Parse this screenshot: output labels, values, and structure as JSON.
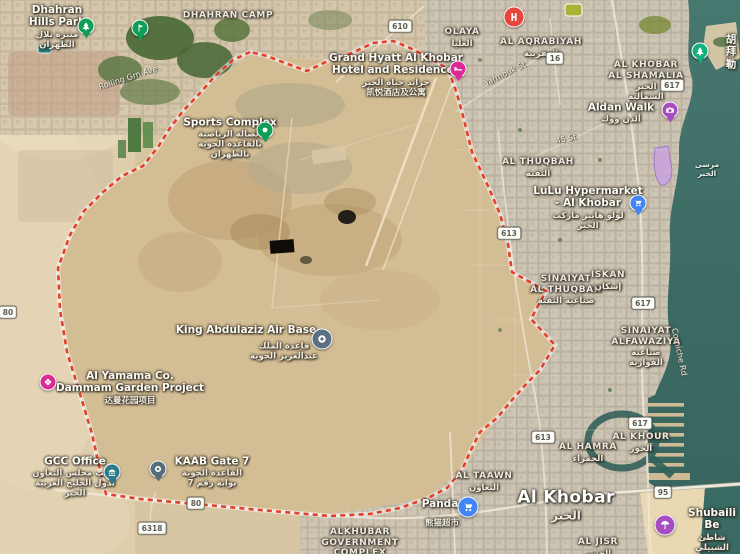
{
  "map": {
    "description": "Satellite map of King Abdulaziz Air Base and Al Khobar, Saudi Arabia",
    "boundary_color": "#e2402c",
    "labels": [
      {
        "id": "dhahran-hills-park",
        "type": "poi",
        "x": 57,
        "y": 27,
        "text": "Dhahran\nHills Park",
        "sub": "منتزه تلال\nالظهران"
      },
      {
        "id": "dhahran-camp",
        "type": "district",
        "x": 228,
        "y": 16,
        "text": "DHAHRAN CAMP",
        "sub": ""
      },
      {
        "id": "olaya",
        "type": "district",
        "x": 462,
        "y": 38,
        "text": "OLAYA",
        "sub": "العليا"
      },
      {
        "id": "al-aqrabiyah",
        "type": "district",
        "x": 541,
        "y": 48,
        "text": "AL AQRABIYAH",
        "sub": "العقربية"
      },
      {
        "id": "al-khobar-al-shamalia",
        "type": "district",
        "x": 646,
        "y": 81,
        "text": "AL KHOBAR\nAL SHAMALIA",
        "sub": "الخبر\nالشمالية"
      },
      {
        "id": "hubail-cn",
        "type": "poi",
        "x": 731,
        "y": 52,
        "text": "胡拜勒",
        "sub": ""
      },
      {
        "id": "grand-hyatt",
        "type": "poi",
        "x": 396,
        "y": 75,
        "text": "Grand Hyatt Al Khobar\nHotel and Residences",
        "sub": "جراند حياة الخبر\n凯悦酒店及公寓"
      },
      {
        "id": "aldan-walk",
        "type": "poi",
        "x": 621,
        "y": 113,
        "text": "Aldan Walk",
        "sub": "ألدن ووك"
      },
      {
        "id": "sports-complex",
        "type": "poi",
        "x": 230,
        "y": 138,
        "text": "Sports Complex",
        "sub": "الصالة الرياضية\nبالقاعدة الجوية\nبالظهران"
      },
      {
        "id": "al-thuqbah",
        "type": "district",
        "x": 538,
        "y": 168,
        "text": "AL THUQBAH",
        "sub": "الثقبة"
      },
      {
        "id": "lulu-hypermarket",
        "type": "poi",
        "x": 588,
        "y": 208,
        "text": "LuLu Hypermarket\n- Al Khobar",
        "sub": "لولو هايبر ماركت\nالخبر"
      },
      {
        "id": "khobar-marina-ar",
        "type": "water",
        "x": 707,
        "y": 170,
        "text": "مرسى الخبر",
        "sub": ""
      },
      {
        "id": "sinaiyat-al-thuqbah",
        "type": "district",
        "x": 566,
        "y": 290,
        "text": "SINAIYAT\nAL THUQBAH",
        "sub": "صناعية الثقبة"
      },
      {
        "id": "iskan",
        "type": "district",
        "x": 608,
        "y": 281,
        "text": "ISKAN",
        "sub": "إسكان"
      },
      {
        "id": "sinaiyat-alfawaziya",
        "type": "district",
        "x": 646,
        "y": 347,
        "text": "SINAIYAT\nALFAWAZIYA",
        "sub": "صناعية\nالفوازية"
      },
      {
        "id": "corniche-rd",
        "type": "street",
        "x": 679,
        "y": 352,
        "rot": 78,
        "text": "Corniche Rd",
        "sub": ""
      },
      {
        "id": "king-abdulaziz-air-base",
        "type": "poi",
        "x": 246,
        "y": 330,
        "text": "King Abdulaziz Air Base",
        "sub": ""
      },
      {
        "id": "king-abdulaziz-air-base-ar",
        "type": "subonly",
        "x": 284,
        "y": 351,
        "text": "",
        "sub": "قاعدة الملك\nعبدالعزيز الجوية"
      },
      {
        "id": "al-yamama-project",
        "type": "poi",
        "x": 130,
        "y": 388,
        "text": "Al Yamama Co.\nDammam Garden Project",
        "sub": "达曼花园项目"
      },
      {
        "id": "al-khour",
        "type": "district",
        "x": 641,
        "y": 443,
        "text": "AL KHOUR",
        "sub": "الخور"
      },
      {
        "id": "al-hamra",
        "type": "district",
        "x": 588,
        "y": 453,
        "text": "AL HAMRA",
        "sub": "الحمراء"
      },
      {
        "id": "gcc-office",
        "type": "poi",
        "x": 75,
        "y": 477,
        "text": "GCC Office",
        "sub": "مكتب مجلس التعاون\nلدول الخليج العربية\nالخبر"
      },
      {
        "id": "kaab-gate-7",
        "type": "poi",
        "x": 212,
        "y": 472,
        "text": "KAAB Gate 7",
        "sub": "القاعدة الجوية\nبوابة رقم 7"
      },
      {
        "id": "al-taawn",
        "type": "district",
        "x": 484,
        "y": 482,
        "text": "AL TAAWN",
        "sub": "التعاون"
      },
      {
        "id": "al-khobar-city",
        "type": "city",
        "x": 566,
        "y": 505,
        "text": "Al Khobar",
        "sub": "الخبر"
      },
      {
        "id": "panda",
        "type": "poi",
        "x": 440,
        "y": 504,
        "text": "Panda",
        "sub": ""
      },
      {
        "id": "panda-cn",
        "type": "subonly",
        "x": 442,
        "y": 523,
        "text": "",
        "sub": "熊猫超市"
      },
      {
        "id": "al-jisr",
        "type": "district",
        "x": 598,
        "y": 548,
        "text": "AL JISR",
        "sub": "الجسر"
      },
      {
        "id": "alkhubar-government-complex",
        "type": "district",
        "x": 360,
        "y": 543,
        "text": "ALKHUBAR\nGOVERNMENT\nCOMPLEX",
        "sub": ""
      },
      {
        "id": "shubaili-beach",
        "type": "poi",
        "x": 712,
        "y": 530,
        "text": "Shubaili Be",
        "sub": "شاطئ الشبيلي"
      },
      {
        "id": "rolling-grn-ave",
        "type": "street",
        "x": 128,
        "y": 78,
        "rot": -18,
        "text": "Rolling Grn Ave",
        "sub": ""
      },
      {
        "id": "yarmouk-st",
        "type": "street",
        "x": 505,
        "y": 74,
        "rot": -26,
        "text": "Yarmouk St",
        "sub": ""
      },
      {
        "id": "45-st",
        "type": "street",
        "x": 566,
        "y": 139,
        "rot": -12,
        "text": "45 St",
        "sub": ""
      }
    ],
    "pins": [
      {
        "id": "dhahran-hills-park",
        "icon": "tree",
        "color": "#0f9d58",
        "x": 86,
        "y": 26,
        "tail": true
      },
      {
        "id": "golf-course",
        "icon": "golf",
        "color": "#0f9d58",
        "x": 140,
        "y": 28,
        "tail": true
      },
      {
        "id": "sports-complex",
        "icon": "dot",
        "color": "#0f9d58",
        "x": 265,
        "y": 130,
        "tail": true
      },
      {
        "id": "grand-hyatt",
        "icon": "bed",
        "color": "#de2a96",
        "x": 458,
        "y": 69,
        "tail": true
      },
      {
        "id": "hospital",
        "icon": "hletter",
        "color": "#e8453c",
        "x": 514,
        "y": 17,
        "tail": false,
        "big": true
      },
      {
        "id": "corniche-tree",
        "icon": "tree",
        "color": "#12b07a",
        "x": 700,
        "y": 51,
        "tail": true
      },
      {
        "id": "aldan-walk",
        "icon": "camera",
        "color": "#a64dbf",
        "x": 670,
        "y": 110,
        "tail": true
      },
      {
        "id": "lulu-hypermarket",
        "icon": "cart",
        "color": "#4285f4",
        "x": 638,
        "y": 203,
        "tail": true
      },
      {
        "id": "air-base",
        "icon": "ring",
        "color": "#5b7083",
        "x": 322,
        "y": 339,
        "tail": false,
        "big": true
      },
      {
        "id": "al-yamama",
        "icon": "flower",
        "color": "#de2a96",
        "x": 48,
        "y": 382,
        "tail": false
      },
      {
        "id": "gcc-office",
        "icon": "bank",
        "color": "#2b7b8c",
        "x": 112,
        "y": 472,
        "tail": true
      },
      {
        "id": "kaab-gate",
        "icon": "ring",
        "color": "#546e7a",
        "x": 158,
        "y": 469,
        "tail": true
      },
      {
        "id": "panda",
        "icon": "cart",
        "color": "#4285f4",
        "x": 468,
        "y": 507,
        "tail": false,
        "big": true
      },
      {
        "id": "shubaili-beach",
        "icon": "beach",
        "color": "#a64dbf",
        "x": 665,
        "y": 525,
        "tail": false,
        "big": true
      }
    ],
    "shields": [
      {
        "number": "610",
        "x": 400,
        "y": 26
      },
      {
        "number": "16",
        "x": 555,
        "y": 58
      },
      {
        "number": "617",
        "x": 672,
        "y": 85
      },
      {
        "number": "613",
        "x": 509,
        "y": 233
      },
      {
        "number": "617",
        "x": 643,
        "y": 303
      },
      {
        "number": "617",
        "x": 640,
        "y": 423
      },
      {
        "number": "613",
        "x": 543,
        "y": 437
      },
      {
        "number": "80",
        "x": 8,
        "y": 312
      },
      {
        "number": "80",
        "x": 196,
        "y": 503
      },
      {
        "number": "6318",
        "x": 152,
        "y": 528
      },
      {
        "number": "95",
        "x": 663,
        "y": 492
      }
    ]
  }
}
